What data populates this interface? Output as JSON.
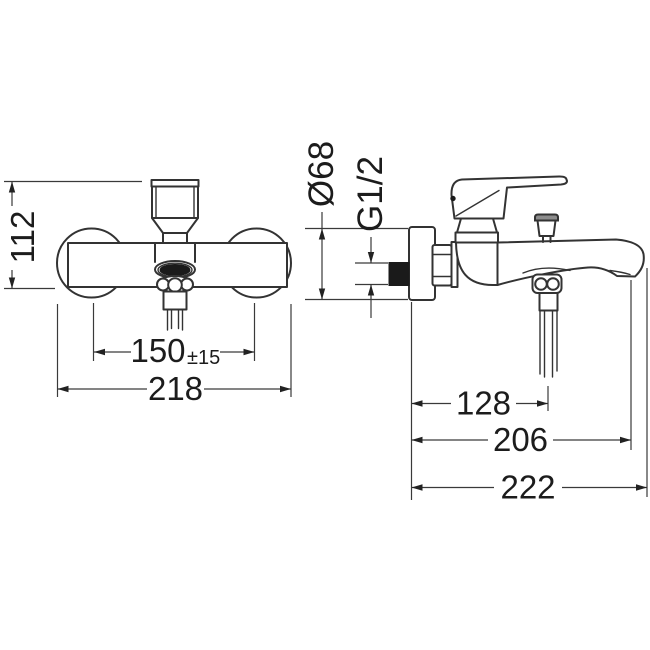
{
  "front_view": {
    "height": "112",
    "hole_spacing": "150",
    "hole_spacing_tolerance": "±15",
    "overall_width": "218"
  },
  "side_view": {
    "escutcheon_diameter": "Ø68",
    "connection_thread": "G1/2",
    "shower_outlet_depth": "128",
    "spout_outlet_depth": "206",
    "overall_depth": "222"
  },
  "colors": {
    "line": "#333333",
    "background": "#ffffff",
    "solid_fill": "#1a1a1a"
  }
}
